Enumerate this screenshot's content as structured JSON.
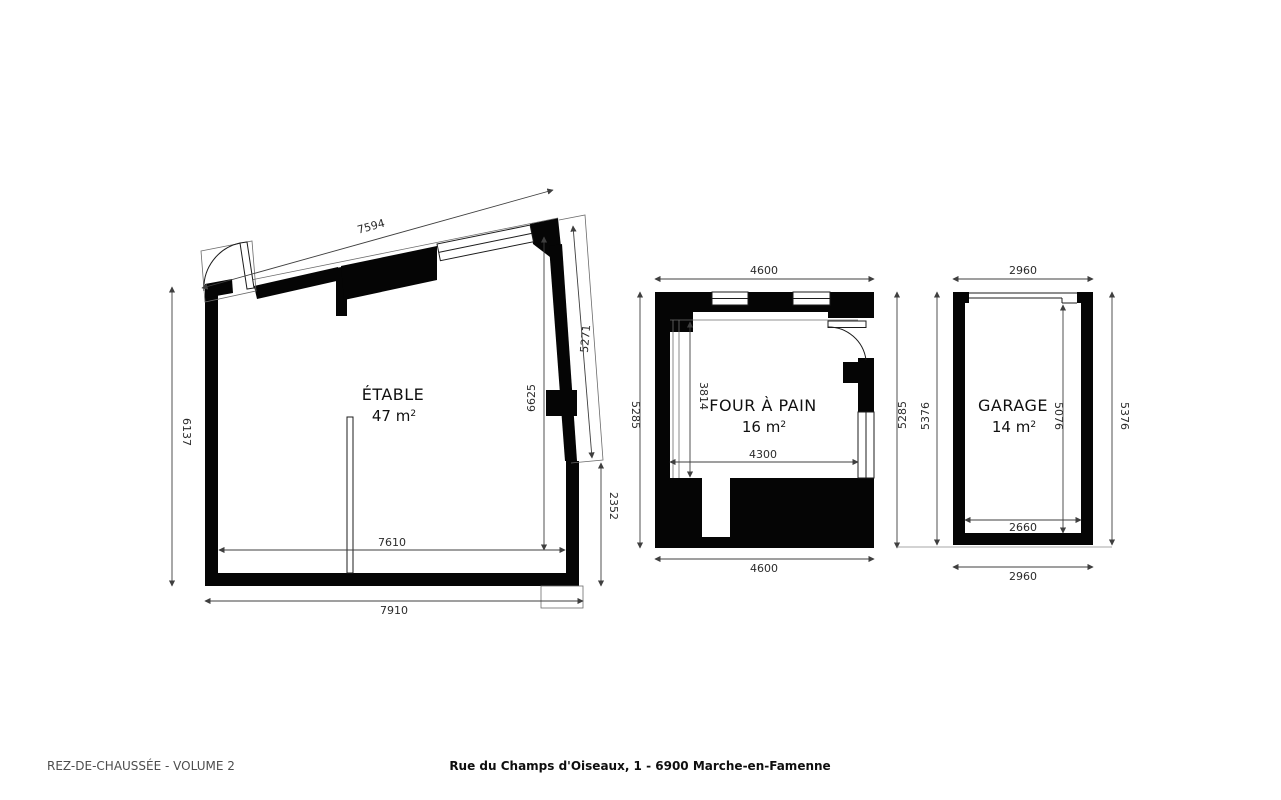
{
  "title_block": {
    "left": "REZ-DE-CHAUSSÉE - VOLUME 2",
    "center": "Rue du Champs d'Oiseaux, 1 - 6900 Marche-en-Famenne"
  },
  "colors": {
    "background": "#ffffff",
    "walls": "#050505",
    "dimension_lines": "#3f3f3f",
    "dimension_text": "#2b2b2b",
    "footer_left_text": "#4d4d4d",
    "footer_center_text": "#0f0f0f"
  },
  "plans": {
    "etable": {
      "name": "ÉTABLE",
      "area": "47 m",
      "area_sup": "2",
      "dims": {
        "top": "7594",
        "left": "6137",
        "right": "5271",
        "inner_right": "6625",
        "lower_right": "2352",
        "inner_bottom": "7610",
        "bottom": "7910"
      }
    },
    "four_a_pain": {
      "name": "FOUR À PAIN",
      "area": "16 m",
      "area_sup": "2",
      "dims": {
        "top": "4600",
        "left": "5285",
        "inner_left": "3814",
        "inner_bottom": "4300",
        "right": "5285",
        "bottom": "4600"
      }
    },
    "garage": {
      "name": "GARAGE",
      "area": "14 m",
      "area_sup": "2",
      "dims": {
        "top": "2960",
        "left": "5376",
        "inner_right": "5076",
        "inner_bottom": "2660",
        "right": "5376",
        "bottom": "2960"
      }
    }
  }
}
